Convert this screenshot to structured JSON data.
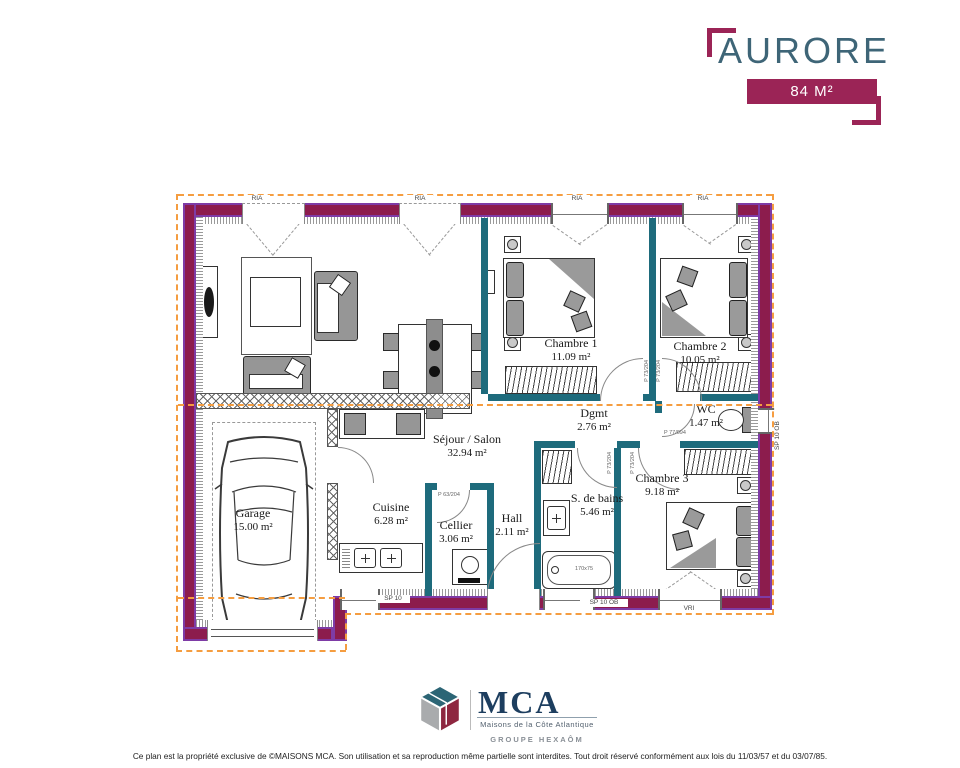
{
  "header": {
    "title": "AURORE",
    "area_badge": "84 M²"
  },
  "rooms": {
    "sejour": {
      "name": "Séjour / Salon",
      "area": "32.94 m²"
    },
    "chambre1": {
      "name": "Chambre 1",
      "area": "11.09 m²"
    },
    "chambre2": {
      "name": "Chambre 2",
      "area": "10.05 m²"
    },
    "chambre3": {
      "name": "Chambre 3",
      "area": "9.18 m²"
    },
    "dgmt": {
      "name": "Dgmt",
      "area": "2.76 m²"
    },
    "wc": {
      "name": "WC",
      "area": "1.47 m²"
    },
    "cuisine": {
      "name": "Cuisine",
      "area": "6.28 m²"
    },
    "cellier": {
      "name": "Cellier",
      "area": "3.06 m²"
    },
    "hall": {
      "name": "Hall",
      "area": "2.11 m²"
    },
    "bains": {
      "name": "S. de bains",
      "area": "5.46 m²"
    },
    "garage": {
      "name": "Garage",
      "area": "15.00 m²"
    }
  },
  "annotations": {
    "ria": "RIA",
    "vri": "VRI",
    "sp10": "SP 10",
    "sp10ob": "SP 10 OB",
    "door_p63": "P 63/204",
    "door_p73": "P 73/204",
    "door_p77": "P 77/094",
    "bathtub_size": "170x75"
  },
  "footer": {
    "logo_text": "MCA",
    "logo_tagline": "Maisons de la Côte Atlantique",
    "logo_group": "GROUPE HEXAÔM"
  },
  "legal": "Ce plan est la propriété exclusive de ©MAISONS MCA. Son utilisation et sa reproduction même partielle sont interdites. Tout droit réservé conformément aux lois du 11/03/57 et du 03/07/85.",
  "colors": {
    "exterior_wall": "#8c1c4d",
    "wall_edge": "#7e3ba6",
    "interior_wall": "#1e6b7c",
    "roof_line": "#f59d40",
    "title_text": "#3e6577",
    "badge_bg": "#9b2456",
    "logo_navy": "#1d3e5f"
  }
}
